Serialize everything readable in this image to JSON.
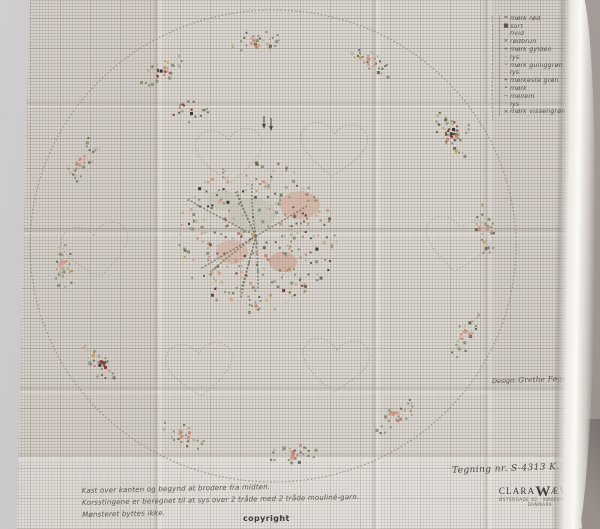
{
  "photo": {
    "description": "Photograph of a folded Clara Wæver cross-stitch pattern sheet for a round tablecloth with hearts and flower wreath",
    "background_color": "#bcb6b2",
    "paper_color": "#dcd7d1",
    "grid_line_color": "#8d8377"
  },
  "legend": {
    "rows": [
      {
        "symbol": "=",
        "label": "mørk rød",
        "ditto": ""
      },
      {
        "symbol": "■",
        "label": "sort",
        "ditto": ""
      },
      {
        "symbol": "",
        "label": "hvid",
        "ditto": ""
      },
      {
        "symbol": "×",
        "label": "rødbrun",
        "ditto": ""
      },
      {
        "symbol": "÷",
        "label": "mørk gylden",
        "ditto": ""
      },
      {
        "symbol": "·",
        "label": "lys",
        "ditto": "″"
      },
      {
        "symbol": "∘",
        "label": "mørk gulliggrøn",
        "ditto": ""
      },
      {
        "symbol": "·",
        "label": "lys",
        "ditto": "″"
      },
      {
        "symbol": "+",
        "label": "mørkeste grøn",
        "ditto": ""
      },
      {
        "symbol": "•",
        "label": "mørk",
        "ditto": "″"
      },
      {
        "symbol": "−",
        "label": "mellem",
        "ditto": "″"
      },
      {
        "symbol": "·",
        "label": "lys",
        "ditto": "″"
      },
      {
        "symbol": "×",
        "label": "mørk vissengrøn",
        "ditto": ""
      }
    ]
  },
  "designer": {
    "label": "Design:",
    "name": "Grethe Føge"
  },
  "footer": {
    "drawing_no": "Tegning nr. S-4313 K.",
    "brand_pre": "CLARA",
    "brand_w": "W",
    "brand_post": "ÆVER",
    "address1": "ØSTERGADE 42 · KØBENHAVN K.",
    "address2": "DANMARK"
  },
  "notes": {
    "line1": "Kast over kanten og begynd at brodere fra midten.",
    "line2": "Korsstingene er beregnet til at sys over 2 tråde med 2 tråde mouliné-garn.",
    "line3": "Mønsteret byttes ikke.",
    "copyright": "copyright"
  },
  "pattern": {
    "motifs": [
      "stitched hem circle",
      "six dotted heart outlines",
      "wreath of twelve flower sprigs",
      "central rose bouquet",
      "centre marking arrows"
    ],
    "palette": {
      "stitch_outline": "#978d80",
      "green_dark": "#6b6e55",
      "green_mid": "#8d9177",
      "green_light": "#b3b59e",
      "rose_peach": "#cf9e89",
      "rose_salmon": "#c28471",
      "rose_dark": "#7e3e35",
      "gold": "#c2a06b",
      "accent_black": "#3a3a36",
      "ink": "#55504a"
    }
  }
}
